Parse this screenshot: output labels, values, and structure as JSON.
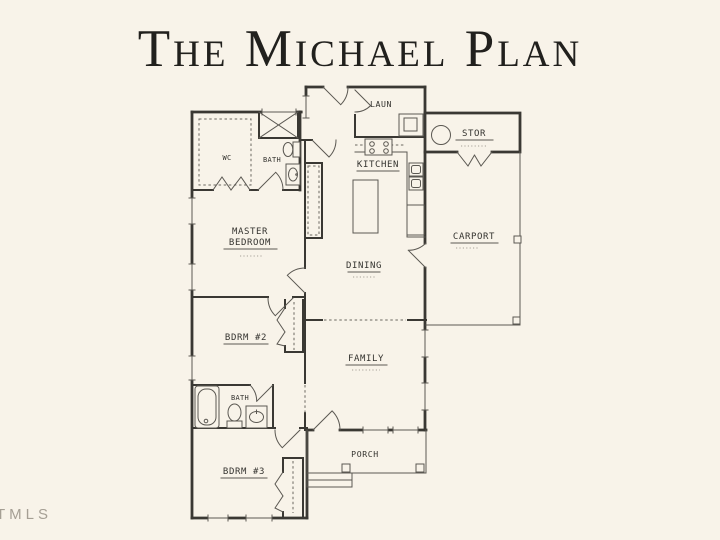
{
  "page": {
    "title": "The Michael Plan",
    "watermark": "TMLS"
  },
  "colors": {
    "background": "#f8f3e9",
    "title": "#21201d",
    "ink": "#3a3833",
    "watermark": "#a59f94"
  },
  "rooms": {
    "wc": "WC",
    "bath_master": "BATH",
    "laundry": "LAUN",
    "storage": "STOR",
    "kitchen": "KITCHEN",
    "master_line1": "MASTER",
    "master_line2": "BEDROOM",
    "carport": "CARPORT",
    "dining": "DINING",
    "bedroom2": "BDRM #2",
    "family": "FAMILY",
    "bath_hall": "BATH",
    "bedroom3": "BDRM #3",
    "porch": "PORCH"
  }
}
